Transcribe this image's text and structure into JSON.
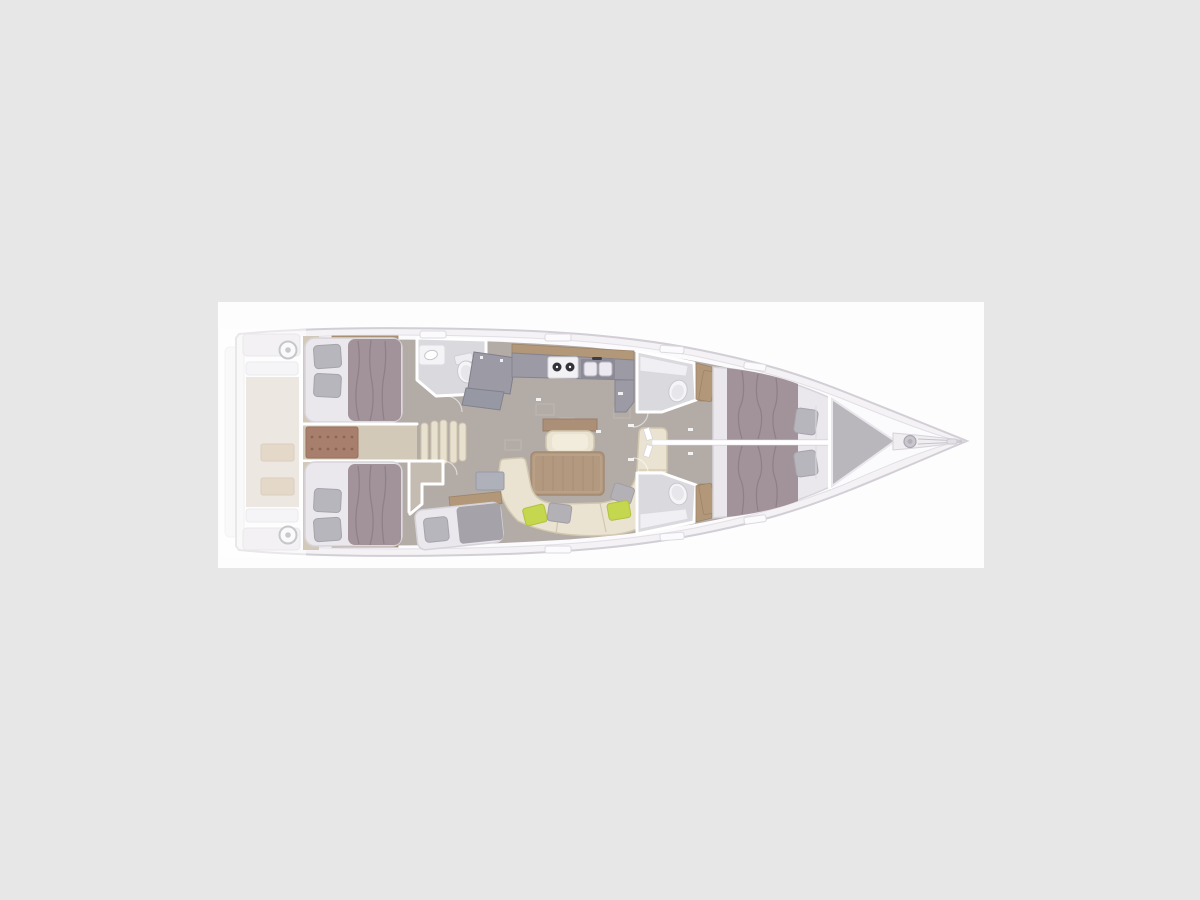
{
  "app": {
    "name": "yacht-interior-floor-plan",
    "view": "top-down deck layout, bow to the right"
  },
  "palette": {
    "bg": "#e8e7e8",
    "panel": "#fdfdfe",
    "deck": "#f4f2f5",
    "deck-stroke": "#d2ced5",
    "deck-inner": "#fbfafc",
    "floor": "#b2aba6",
    "wood-floor": "#d3c9b9",
    "wood-trim": "#b29879",
    "wood-trim-dark": "#9e8468",
    "engine": "#a87f6d",
    "mattress": "#eae8ec",
    "duvet": "#a2939b",
    "duvet-line": "#8c7b84",
    "duvet-gray": "#a5a2aa",
    "pillow": "#b7b6bc",
    "wall": "#ffffff",
    "counter": "#9c9ba5",
    "counter-dark": "#8b8a95",
    "appliance": "#f2f1f4",
    "burner": "#33333a",
    "basin": "#eceaf0",
    "bath-floor": "#dad9de",
    "porcelain": "#f5f4f7",
    "porcelain-inner": "#e7e6ea",
    "sofa": "#ebe3d1",
    "sofa-inner": "#f2ecdd",
    "table": "#b2997f",
    "table-line": "#a58c72",
    "cushion-green": "#c5d74e",
    "cushion-gray": "#b3b1b6",
    "locker": "#b9b6bc",
    "metal": "#c9c6cd"
  },
  "components": {
    "boat": {
      "label": "Sailing yacht interior floor plan, top view, bow pointing right"
    },
    "swim_platform": {
      "label": "Fold-down transom swim platform"
    },
    "cockpit": {
      "label": "Cockpit with twin helm wheels and cockpit table (faded)"
    },
    "helm_top": {
      "label": "Helm steering wheel"
    },
    "helm_bottom": {
      "label": "Helm steering wheel"
    },
    "aft_cabin_top": {
      "label": "Aft double cabin with athwartship berth"
    },
    "aft_cabin_bottom": {
      "label": "Aft double cabin with athwartship berth"
    },
    "engine_room": {
      "label": "Engine compartment between aft cabins"
    },
    "companionway": {
      "label": "Companionway entry steps"
    },
    "aft_head": {
      "label": "Aft head with washbasin and toilet"
    },
    "nav_station": {
      "label": "Navigation station chart table"
    },
    "galley": {
      "label": "Galley with two-burner stove and double sink"
    },
    "salon": {
      "label": "Salon with dining table, seat and U-shaped sofa"
    },
    "berth_cabin": {
      "label": "Lower single-berth cabin beside companionway"
    },
    "forward_head_top": {
      "label": "Forward head with toilet and shower"
    },
    "forward_head_bottom": {
      "label": "Forward head with toilet and shower"
    },
    "forward_cabin_top": {
      "label": "Forward double cabin"
    },
    "forward_cabin_bottom": {
      "label": "Forward double cabin"
    },
    "sail_locker": {
      "label": "Bow sail locker"
    },
    "bow_fitting": {
      "label": "Bowsprit with anchor windlass"
    }
  }
}
